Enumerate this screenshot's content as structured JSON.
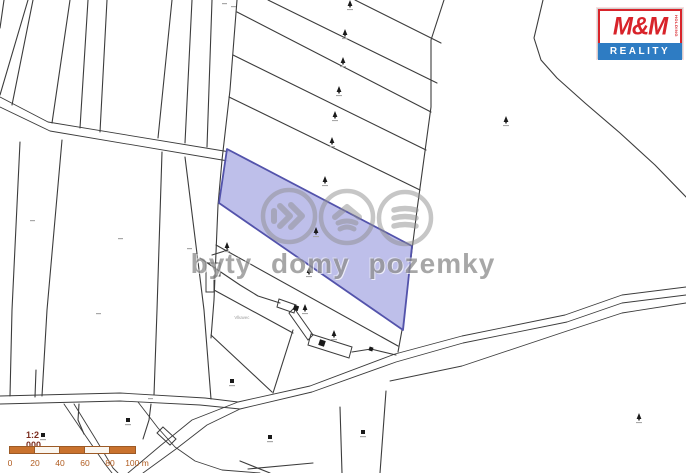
{
  "title": "Cadastral map with highlighted parcel",
  "watermark": {
    "text": "byty domy pozemky",
    "color": "#8f8f8f",
    "circles": [
      {
        "cx": 289,
        "cy": 216,
        "icon": "signal-right-icon"
      },
      {
        "cx": 347,
        "cy": 217,
        "icon": "house-icon"
      },
      {
        "cx": 405,
        "cy": 218,
        "icon": "stack-icon"
      }
    ],
    "radius": 26
  },
  "logo": {
    "mm": "M&M",
    "holding": "HOLDING",
    "reality": "REALITY",
    "red": "#d8232a",
    "blue": "#2e7cc3"
  },
  "scale": {
    "title": "1:2 000",
    "labels": [
      {
        "text": "0",
        "x": 10
      },
      {
        "text": "20",
        "x": 35
      },
      {
        "text": "40",
        "x": 60
      },
      {
        "text": "60",
        "x": 85
      },
      {
        "text": "80",
        "x": 110
      },
      {
        "text": "100 m",
        "x": 137
      }
    ],
    "segments": [
      "#c9722e",
      "#faf6f0",
      "#c9722e",
      "#faf6f0",
      "#c9722e"
    ],
    "bar_border": "#9c5a26"
  },
  "map": {
    "place_label": "Vlkavec",
    "colors": {
      "line": "#3c3c3c",
      "parcel_fill": "#b9bae8",
      "parcel_stroke": "#5353ab",
      "symbol": "#1a1a1a",
      "micro_label": "#a8a8a8"
    },
    "highlighted_parcel": {
      "pts": [
        [
          227,
          149
        ],
        [
          412,
          246
        ],
        [
          403,
          330
        ],
        [
          219,
          203
        ]
      ]
    },
    "polylines": [
      {
        "name": "boundary-line",
        "pts": [
          [
            4,
            0
          ],
          [
            0,
            28
          ]
        ]
      },
      {
        "name": "boundary-line",
        "pts": [
          [
            28,
            0
          ],
          [
            0,
            95
          ]
        ]
      },
      {
        "name": "boundary-line",
        "pts": [
          [
            33,
            0
          ],
          [
            12,
            105
          ]
        ]
      },
      {
        "name": "boundary-line",
        "pts": [
          [
            70,
            0
          ],
          [
            52,
            123
          ]
        ]
      },
      {
        "name": "boundary-line",
        "pts": [
          [
            88,
            0
          ],
          [
            80,
            128
          ]
        ]
      },
      {
        "name": "boundary-line",
        "pts": [
          [
            107,
            0
          ],
          [
            100,
            132
          ]
        ]
      },
      {
        "name": "boundary-line",
        "pts": [
          [
            172,
            0
          ],
          [
            158,
            138
          ]
        ]
      },
      {
        "name": "boundary-line",
        "pts": [
          [
            192,
            0
          ],
          [
            185,
            143
          ]
        ]
      },
      {
        "name": "boundary-line",
        "pts": [
          [
            212,
            0
          ],
          [
            207,
            147
          ]
        ]
      },
      {
        "name": "path-edge",
        "pts": [
          [
            0,
            97
          ],
          [
            48,
            122
          ],
          [
            230,
            152
          ]
        ]
      },
      {
        "name": "path-edge",
        "pts": [
          [
            0,
            107
          ],
          [
            50,
            131
          ],
          [
            228,
            161
          ]
        ]
      },
      {
        "name": "boundary-line",
        "pts": [
          [
            20,
            142
          ],
          [
            12,
            310
          ],
          [
            10,
            396
          ]
        ]
      },
      {
        "name": "boundary-line",
        "pts": [
          [
            62,
            140
          ],
          [
            47,
            310
          ],
          [
            42,
            396
          ]
        ]
      },
      {
        "name": "boundary-line",
        "pts": [
          [
            162,
            152
          ],
          [
            157,
            310
          ],
          [
            154,
            395
          ]
        ]
      },
      {
        "name": "boundary-line",
        "pts": [
          [
            185,
            157
          ],
          [
            204,
            310
          ],
          [
            211,
            399
          ]
        ]
      },
      {
        "name": "boundary-line",
        "pts": [
          [
            36,
            370
          ],
          [
            35,
            397
          ]
        ]
      },
      {
        "name": "boundary-line",
        "pts": [
          [
            79,
            404
          ],
          [
            78,
            420
          ],
          [
            84,
            434
          ]
        ]
      },
      {
        "name": "boundary-line",
        "pts": [
          [
            151,
            404
          ],
          [
            149,
            420
          ],
          [
            143,
            439
          ]
        ]
      },
      {
        "name": "strip-left-boundary",
        "pts": [
          [
            237,
            0
          ],
          [
            230,
            90
          ],
          [
            222,
            160
          ],
          [
            218,
            205
          ],
          [
            214,
            300
          ],
          [
            211,
            338
          ]
        ]
      },
      {
        "name": "strip-right-boundary",
        "pts": [
          [
            444,
            0
          ],
          [
            431,
            40
          ],
          [
            431,
            107
          ],
          [
            417,
            210
          ],
          [
            402,
            330
          ],
          [
            398,
            352
          ]
        ]
      },
      {
        "name": "strip-line",
        "pts": [
          [
            355,
            0
          ],
          [
            441,
            43
          ]
        ]
      },
      {
        "name": "strip-line",
        "pts": [
          [
            268,
            0
          ],
          [
            437,
            83
          ]
        ]
      },
      {
        "name": "strip-line",
        "pts": [
          [
            237,
            12
          ],
          [
            431,
            112
          ]
        ]
      },
      {
        "name": "strip-line",
        "pts": [
          [
            233,
            55
          ],
          [
            426,
            150
          ]
        ]
      },
      {
        "name": "strip-line",
        "pts": [
          [
            229,
            97
          ],
          [
            420,
            190
          ]
        ]
      },
      {
        "name": "strip-line",
        "pts": [
          [
            216,
            245
          ],
          [
            398,
            346
          ]
        ]
      },
      {
        "name": "strip-line",
        "pts": [
          [
            214,
            290
          ],
          [
            293,
            333
          ]
        ]
      },
      {
        "name": "strip-line",
        "pts": [
          [
            211,
            335
          ],
          [
            272,
            392
          ]
        ]
      },
      {
        "name": "boundary-line",
        "pts": [
          [
            293,
            330
          ],
          [
            273,
            393
          ]
        ]
      },
      {
        "name": "yard-boundary",
        "pts": [
          [
            200,
            258
          ],
          [
            240,
            285
          ],
          [
            258,
            296
          ],
          [
            280,
            303
          ]
        ]
      },
      {
        "name": "boundary-line",
        "pts": [
          [
            212,
            255
          ],
          [
            228,
            250
          ]
        ]
      },
      {
        "name": "field-boundary-curve",
        "pts": [
          [
            543,
            0
          ],
          [
            534,
            38
          ],
          [
            541,
            60
          ],
          [
            557,
            78
          ],
          [
            585,
            103
          ],
          [
            620,
            133
          ],
          [
            655,
            165
          ],
          [
            689,
            200
          ]
        ]
      },
      {
        "name": "road-edge",
        "pts": [
          [
            0,
            396
          ],
          [
            120,
            393
          ],
          [
            205,
            398
          ],
          [
            238,
            402
          ]
        ]
      },
      {
        "name": "road-edge",
        "pts": [
          [
            0,
            404
          ],
          [
            120,
            401
          ],
          [
            200,
            405
          ],
          [
            240,
            409
          ]
        ]
      },
      {
        "name": "road-edge",
        "pts": [
          [
            128,
            473
          ],
          [
            160,
            446
          ],
          [
            192,
            420
          ],
          [
            238,
            402
          ],
          [
            310,
            386
          ],
          [
            395,
            354
          ],
          [
            462,
            336
          ],
          [
            565,
            315
          ],
          [
            622,
            295
          ],
          [
            686,
            287
          ]
        ]
      },
      {
        "name": "road-edge",
        "pts": [
          [
            143,
            473
          ],
          [
            176,
            449
          ],
          [
            207,
            425
          ],
          [
            240,
            409
          ],
          [
            312,
            392
          ],
          [
            396,
            362
          ],
          [
            463,
            343
          ],
          [
            567,
            322
          ],
          [
            622,
            303
          ],
          [
            686,
            295
          ]
        ]
      },
      {
        "name": "road-edge",
        "pts": [
          [
            390,
            381
          ],
          [
            462,
            366
          ],
          [
            567,
            331
          ],
          [
            622,
            313
          ],
          [
            686,
            303
          ]
        ]
      },
      {
        "name": "road-edge",
        "pts": [
          [
            64,
            404
          ],
          [
            85,
            435
          ],
          [
            105,
            464
          ],
          [
            112,
            473
          ]
        ]
      },
      {
        "name": "road-edge",
        "pts": [
          [
            74,
            404
          ],
          [
            95,
            438
          ],
          [
            113,
            468
          ],
          [
            118,
            473
          ]
        ]
      },
      {
        "name": "road-edge",
        "pts": [
          [
            138,
            402
          ],
          [
            158,
            428
          ],
          [
            175,
            447
          ],
          [
            195,
            461
          ],
          [
            222,
            470
          ],
          [
            260,
            473
          ]
        ]
      },
      {
        "name": "boundary-line",
        "pts": [
          [
            386,
            391
          ],
          [
            380,
            473
          ]
        ]
      },
      {
        "name": "boundary-line",
        "pts": [
          [
            340,
            407
          ],
          [
            342,
            473
          ]
        ]
      },
      {
        "name": "boundary-line",
        "pts": [
          [
            240,
            461
          ],
          [
            270,
            473
          ]
        ]
      },
      {
        "name": "boundary-line",
        "pts": [
          [
            248,
            469
          ],
          [
            313,
            463
          ]
        ]
      },
      {
        "name": "building-link-line",
        "pts": [
          [
            352,
            352
          ],
          [
            371,
            349
          ],
          [
            396,
            355
          ]
        ]
      }
    ],
    "polygons": [
      {
        "name": "building-outline",
        "pts": [
          [
            279,
            299
          ],
          [
            296,
            305
          ],
          [
            294,
            313
          ],
          [
            277,
            307
          ]
        ],
        "fill": "none"
      },
      {
        "name": "building-outline",
        "pts": [
          [
            294,
            308
          ],
          [
            313,
            335
          ],
          [
            308,
            340
          ],
          [
            289,
            313
          ]
        ],
        "fill": "none"
      },
      {
        "name": "building-outline",
        "pts": [
          [
            311,
            334
          ],
          [
            352,
            347
          ],
          [
            349,
            358
          ],
          [
            308,
            345
          ]
        ],
        "fill": "none"
      },
      {
        "name": "building-outline",
        "pts": [
          [
            206,
            263
          ],
          [
            220,
            263
          ],
          [
            220,
            276
          ],
          [
            214,
            276
          ],
          [
            214,
            292
          ],
          [
            206,
            292
          ]
        ],
        "fill": "none"
      },
      {
        "name": "culvert-symbol",
        "pts": [
          [
            163,
            427
          ],
          [
            176,
            439
          ],
          [
            170,
            445
          ],
          [
            157,
            433
          ]
        ],
        "fill": "none"
      }
    ],
    "filled_squares": [
      {
        "x": 296,
        "y": 308,
        "s": 5
      },
      {
        "x": 322,
        "y": 343,
        "s": 6
      },
      {
        "x": 371,
        "y": 349,
        "s": 4
      }
    ],
    "point_squares": [
      [
        43,
        435
      ],
      [
        128,
        420
      ],
      [
        232,
        381
      ],
      [
        270,
        437
      ],
      [
        363,
        432
      ]
    ],
    "trees": [
      [
        350,
        6
      ],
      [
        345,
        35
      ],
      [
        343,
        63
      ],
      [
        339,
        92
      ],
      [
        335,
        117
      ],
      [
        332,
        143
      ],
      [
        325,
        182
      ],
      [
        316,
        233
      ],
      [
        309,
        273
      ],
      [
        305,
        310
      ],
      [
        334,
        336
      ],
      [
        227,
        248
      ],
      [
        506,
        122
      ],
      [
        639,
        419
      ]
    ],
    "micro_labels": [
      [
        30,
        220
      ],
      [
        118,
        238
      ],
      [
        187,
        248
      ],
      [
        96,
        313
      ],
      [
        148,
        398
      ],
      [
        222,
        3
      ],
      [
        231,
        6
      ]
    ]
  }
}
